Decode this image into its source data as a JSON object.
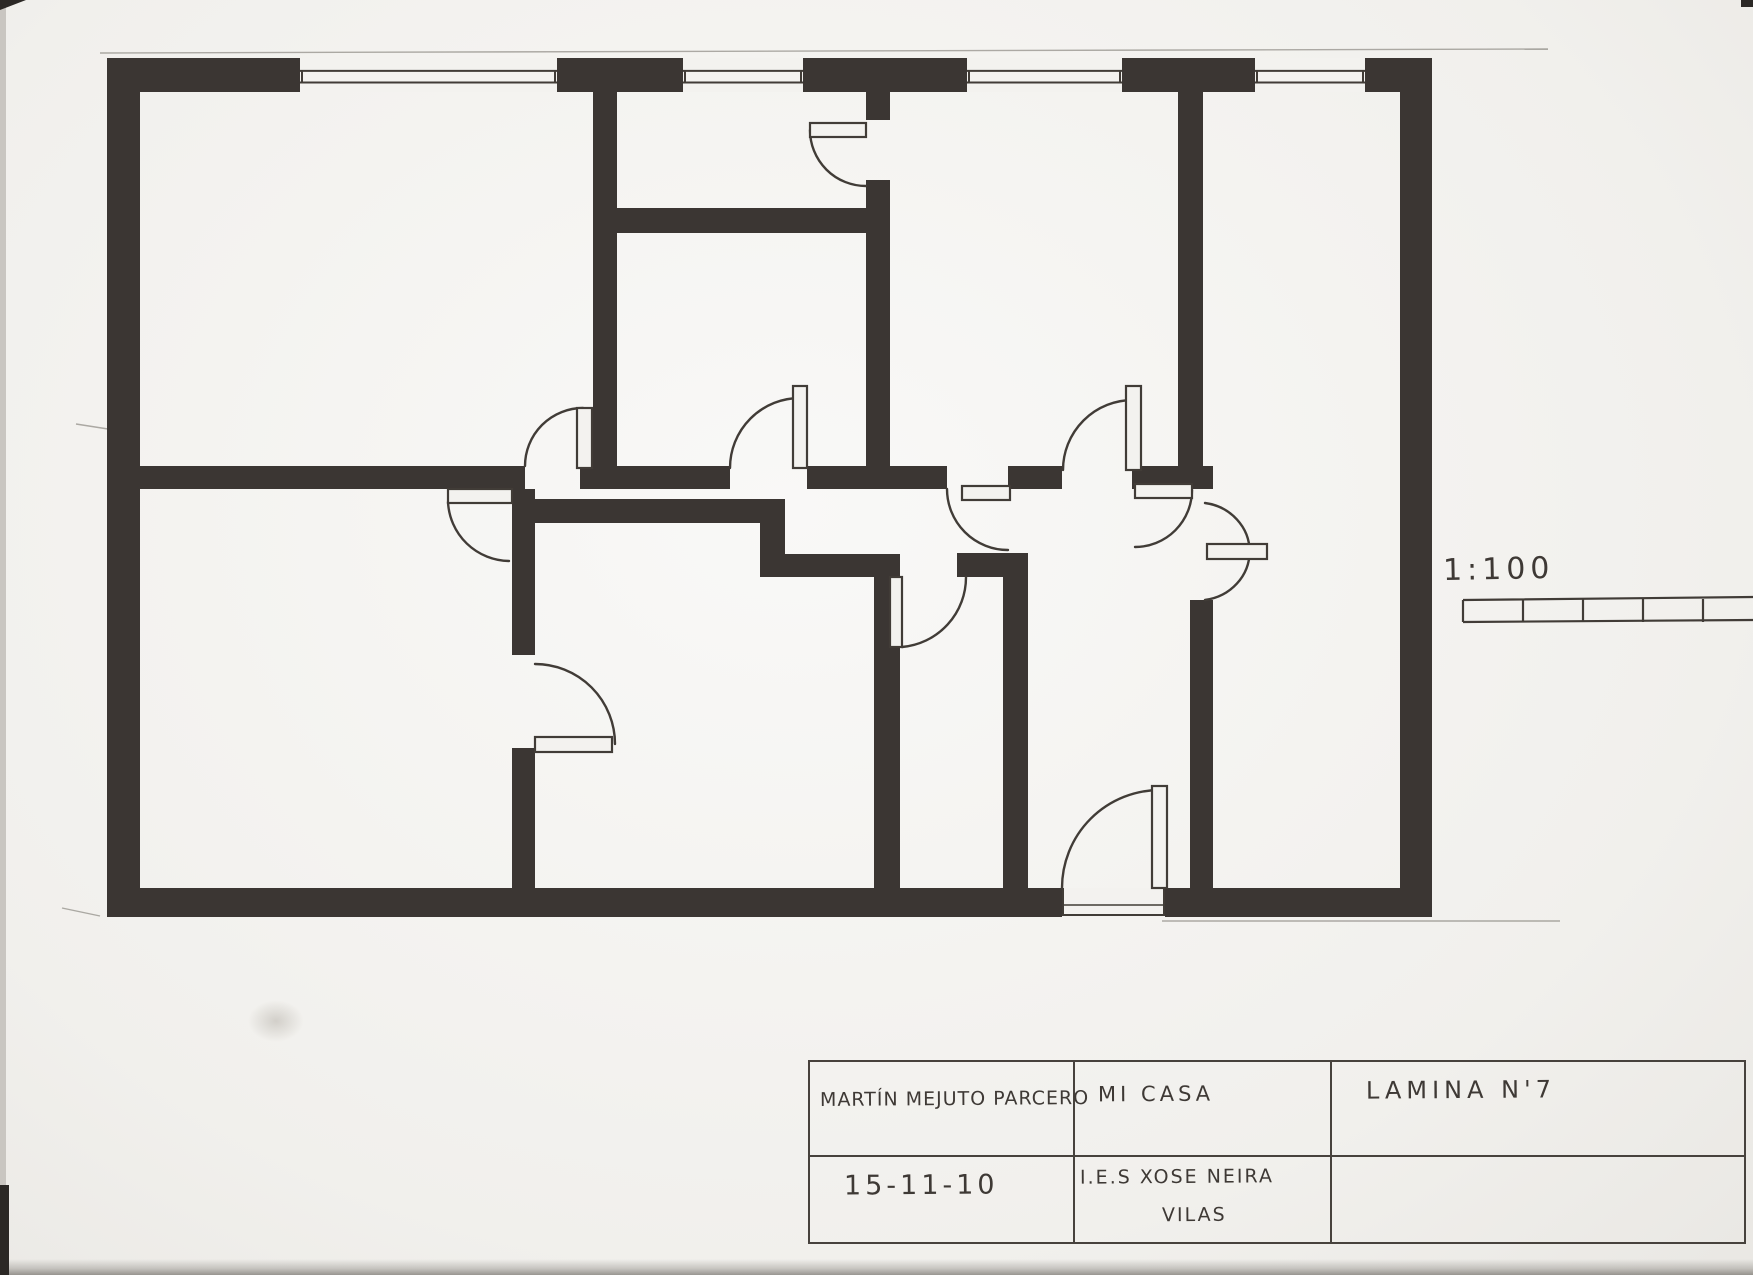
{
  "colors": {
    "paper": "#f3f2ef",
    "ink": "#3b3633",
    "line": "#413c37",
    "pencil": "rgba(100,95,88,0.5)"
  },
  "scale": {
    "label": "1:100"
  },
  "title_block": {
    "author": "MARTÍN MEJUTO PARCERO",
    "project": "MI CASA",
    "sheet": "LAMINA N'7",
    "date": "15-11-10",
    "school_line1": "I.E.S XOSE NEIRA",
    "school_line2": "VILAS"
  },
  "plan": {
    "walls": [
      {
        "name": "wall-exterior-left",
        "x": 107,
        "y": 58,
        "w": 33,
        "h": 859
      },
      {
        "name": "wall-exterior-right",
        "x": 1400,
        "y": 58,
        "w": 32,
        "h": 859
      },
      {
        "name": "wall-exterior-top-1",
        "x": 113,
        "y": 58,
        "w": 187,
        "h": 34
      },
      {
        "name": "wall-exterior-top-2",
        "x": 557,
        "y": 58,
        "w": 126,
        "h": 34
      },
      {
        "name": "wall-exterior-top-3",
        "x": 803,
        "y": 58,
        "w": 164,
        "h": 34
      },
      {
        "name": "wall-exterior-top-4",
        "x": 1122,
        "y": 58,
        "w": 133,
        "h": 34
      },
      {
        "name": "wall-exterior-top-5",
        "x": 1365,
        "y": 58,
        "w": 67,
        "h": 34
      },
      {
        "name": "wall-exterior-bottom-left",
        "x": 107,
        "y": 888,
        "w": 955,
        "h": 29
      },
      {
        "name": "wall-exterior-bottom-right",
        "x": 1165,
        "y": 888,
        "w": 267,
        "h": 29
      },
      {
        "name": "wall-divider-1",
        "x": 140,
        "y": 466,
        "w": 385,
        "h": 23
      },
      {
        "name": "wall-divider-2",
        "x": 580,
        "y": 466,
        "w": 150,
        "h": 23
      },
      {
        "name": "wall-divider-3",
        "x": 807,
        "y": 466,
        "w": 140,
        "h": 23
      },
      {
        "name": "wall-divider-4",
        "x": 1008,
        "y": 466,
        "w": 54,
        "h": 23
      },
      {
        "name": "wall-divider-5",
        "x": 1132,
        "y": 466,
        "w": 81,
        "h": 23
      },
      {
        "name": "wall-topmid-left",
        "x": 593,
        "y": 92,
        "w": 24,
        "h": 374
      },
      {
        "name": "wall-topmid-bottom",
        "x": 593,
        "y": 208,
        "w": 297,
        "h": 25
      },
      {
        "name": "wall-topmid-right-a",
        "x": 866,
        "y": 92,
        "w": 24,
        "h": 28
      },
      {
        "name": "wall-topmid-right-b",
        "x": 866,
        "y": 180,
        "w": 24,
        "h": 286
      },
      {
        "name": "wall-topright-divider",
        "x": 1178,
        "y": 92,
        "w": 25,
        "h": 374
      },
      {
        "name": "wall-hall-right",
        "x": 1190,
        "y": 600,
        "w": 23,
        "h": 288
      },
      {
        "name": "wall-hall-left-top",
        "x": 957,
        "y": 553,
        "w": 71,
        "h": 24
      },
      {
        "name": "wall-hall-left",
        "x": 1003,
        "y": 577,
        "w": 25,
        "h": 311
      },
      {
        "name": "wall-roomk-top",
        "x": 535,
        "y": 499,
        "w": 250,
        "h": 24
      },
      {
        "name": "wall-roomk-left-a",
        "x": 512,
        "y": 489,
        "w": 23,
        "h": 166
      },
      {
        "name": "wall-roomk-left-b",
        "x": 512,
        "y": 748,
        "w": 23,
        "h": 140
      },
      {
        "name": "wall-roomk-jog",
        "x": 760,
        "y": 499,
        "w": 25,
        "h": 78
      },
      {
        "name": "wall-roomk-step",
        "x": 785,
        "y": 554,
        "w": 89,
        "h": 23
      },
      {
        "name": "wall-roomk-right",
        "x": 874,
        "y": 554,
        "w": 26,
        "h": 334
      }
    ],
    "windows": [
      {
        "name": "window-top-1",
        "x": 300,
        "y": 58,
        "w": 257,
        "h": 34
      },
      {
        "name": "window-top-2",
        "x": 683,
        "y": 58,
        "w": 120,
        "h": 34
      },
      {
        "name": "window-top-3",
        "x": 967,
        "y": 58,
        "w": 155,
        "h": 34
      },
      {
        "name": "window-top-4",
        "x": 1255,
        "y": 58,
        "w": 110,
        "h": 34
      }
    ],
    "entrance_opening": {
      "name": "entrance-opening",
      "x": 1062,
      "y": 888,
      "w": 103,
      "h": 29
    },
    "door_leaves": [
      {
        "name": "door-leaf-hall-up",
        "x": 577,
        "y": 408,
        "w": 15,
        "h": 60
      },
      {
        "name": "door-leaf-hall-down",
        "x": 448,
        "y": 489,
        "w": 64,
        "h": 14
      },
      {
        "name": "door-leaf-corridor",
        "x": 793,
        "y": 386,
        "w": 14,
        "h": 82
      },
      {
        "name": "door-leaf-kitchen-top",
        "x": 962,
        "y": 486,
        "w": 48,
        "h": 14
      },
      {
        "name": "door-leaf-livingroom-up",
        "x": 1126,
        "y": 386,
        "w": 15,
        "h": 84
      },
      {
        "name": "door-leaf-livingroom-down",
        "x": 1135,
        "y": 484,
        "w": 57,
        "h": 14
      },
      {
        "name": "door-leaf-entrance",
        "x": 1152,
        "y": 786,
        "w": 15,
        "h": 102
      },
      {
        "name": "door-leaf-topmid-room",
        "x": 810,
        "y": 123,
        "w": 56,
        "h": 14
      },
      {
        "name": "door-leaf-roomk-west",
        "x": 535,
        "y": 737,
        "w": 77,
        "h": 15
      },
      {
        "name": "door-leaf-roomk-east",
        "x": 890,
        "y": 577,
        "w": 12,
        "h": 70
      },
      {
        "name": "door-leaf-bottomright",
        "x": 1207,
        "y": 544,
        "w": 60,
        "h": 15
      }
    ],
    "door_arcs": [
      {
        "name": "door-arc-hall-up",
        "d": "M525,466 A58,58 0 0 1 583,408"
      },
      {
        "name": "door-arc-hall-down",
        "d": "M448,502 A62,62 0 0 0 509,561"
      },
      {
        "name": "door-arc-corridor",
        "d": "M730,468 A70,70 0 0 1 800,398"
      },
      {
        "name": "door-arc-kitchen-top",
        "d": "M947,489 A61,61 0 0 0 1008,550"
      },
      {
        "name": "door-arc-livingroom-up",
        "d": "M1063,470 A70,70 0 0 1 1133,400"
      },
      {
        "name": "door-arc-livingroom-down",
        "d": "M1192,490 A57,57 0 0 1 1135,547"
      },
      {
        "name": "door-arc-entrance",
        "d": "M1062,888 A98,98 0 0 1 1160,790"
      },
      {
        "name": "door-arc-topmid-room",
        "d": "M810,130 A56,56 0 0 0 866,186"
      },
      {
        "name": "door-arc-roomk-west",
        "d": "M535,664 A80,80 0 0 1 615,744"
      },
      {
        "name": "door-arc-roomk-east",
        "d": "M902,647 A70,70 0 0 0 966,577"
      },
      {
        "name": "door-arc-bottomright",
        "d": "M1205,503 A52,49 0 0 1 1205,600"
      }
    ],
    "pencil_lines": [
      {
        "x1": 100,
        "y1": 53,
        "x2": 1548,
        "y2": 49
      },
      {
        "x1": 1162,
        "y1": 921,
        "x2": 1560,
        "y2": 921
      },
      {
        "x1": 76,
        "y1": 424,
        "x2": 108,
        "y2": 429
      },
      {
        "x1": 62,
        "y1": 908,
        "x2": 100,
        "y2": 916
      }
    ],
    "scale_bar": {
      "name": "scale-bar",
      "x": 1463,
      "y": 600,
      "x2": 1753,
      "h": 22,
      "ticks": [
        1523,
        1583,
        1643,
        1703
      ]
    }
  }
}
